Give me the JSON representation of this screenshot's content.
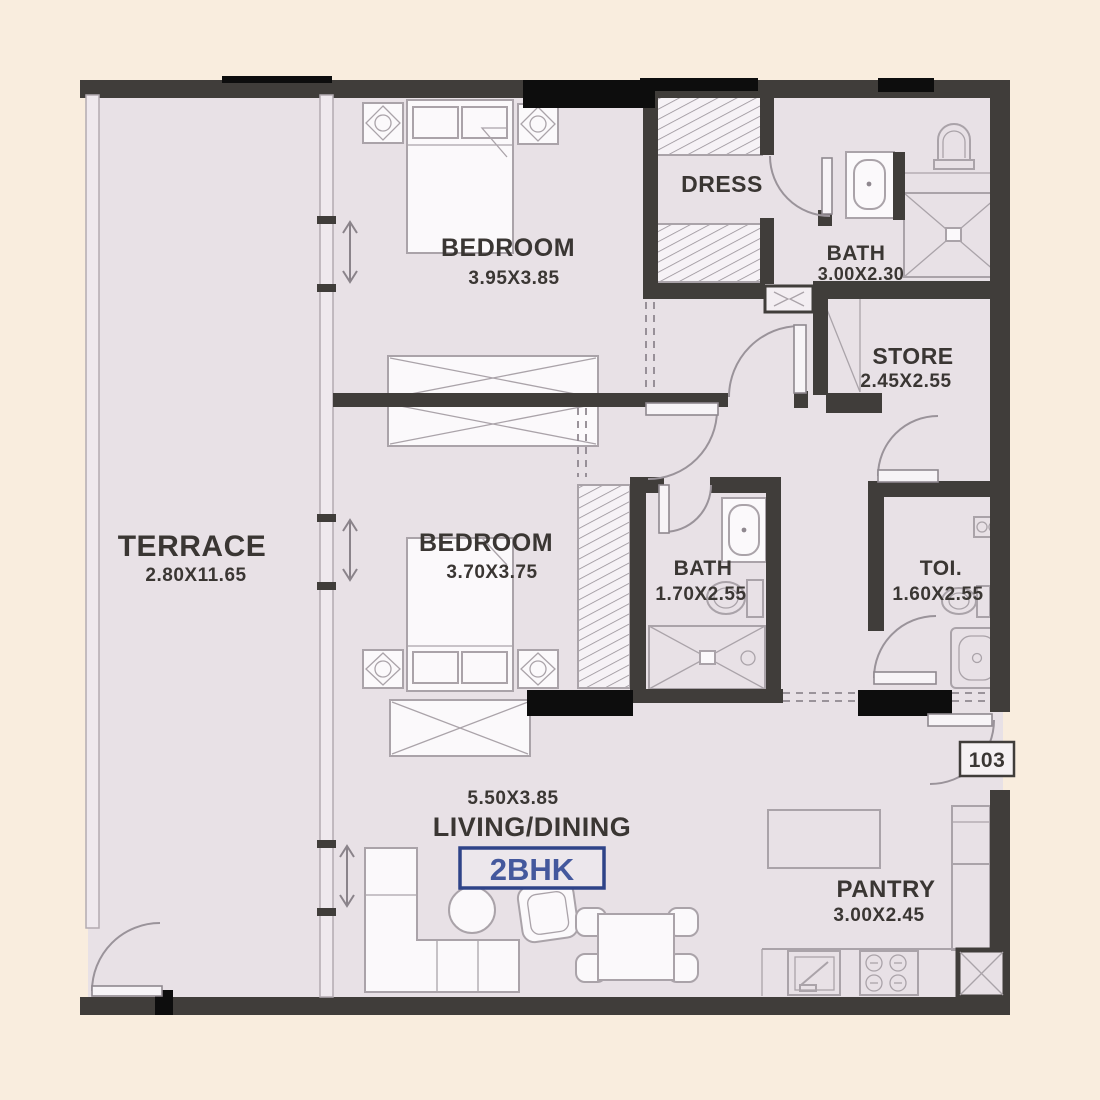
{
  "plan": {
    "title": "2BHK floor plan",
    "badge": "2BHK",
    "unit_number": "103",
    "rooms": [
      {
        "id": "terrace",
        "name": "TERRACE",
        "dims": "2.80X11.65"
      },
      {
        "id": "bedroom1",
        "name": "BEDROOM",
        "dims": "3.95X3.85"
      },
      {
        "id": "dress",
        "name": "DRESS",
        "dims": ""
      },
      {
        "id": "bath1",
        "name": "BATH",
        "dims": "3.00X2.30"
      },
      {
        "id": "store",
        "name": "STORE",
        "dims": "2.45X2.55"
      },
      {
        "id": "bedroom2",
        "name": "BEDROOM",
        "dims": "3.70X3.75"
      },
      {
        "id": "bath2",
        "name": "BATH",
        "dims": "1.70X2.55"
      },
      {
        "id": "toilet",
        "name": "TOI.",
        "dims": "1.60X2.55"
      },
      {
        "id": "living",
        "name": "LIVING/DINING",
        "dims": "5.50X3.85"
      },
      {
        "id": "pantry",
        "name": "PANTRY",
        "dims": "3.00X2.45"
      }
    ],
    "colors": {
      "background": "#f9edde",
      "floor": "#e8e1e6",
      "wall": "#403d3a",
      "wall_black": "#0d0d0d",
      "light_wall": "#efe9ee",
      "furniture_stroke": "#aaa3a9",
      "furniture_fill": "#fbf9fb",
      "label": "#3a3633",
      "accent_blue_border": "#2e4388",
      "accent_blue_text": "#44589d",
      "arc_stroke": "#9a939a"
    }
  }
}
